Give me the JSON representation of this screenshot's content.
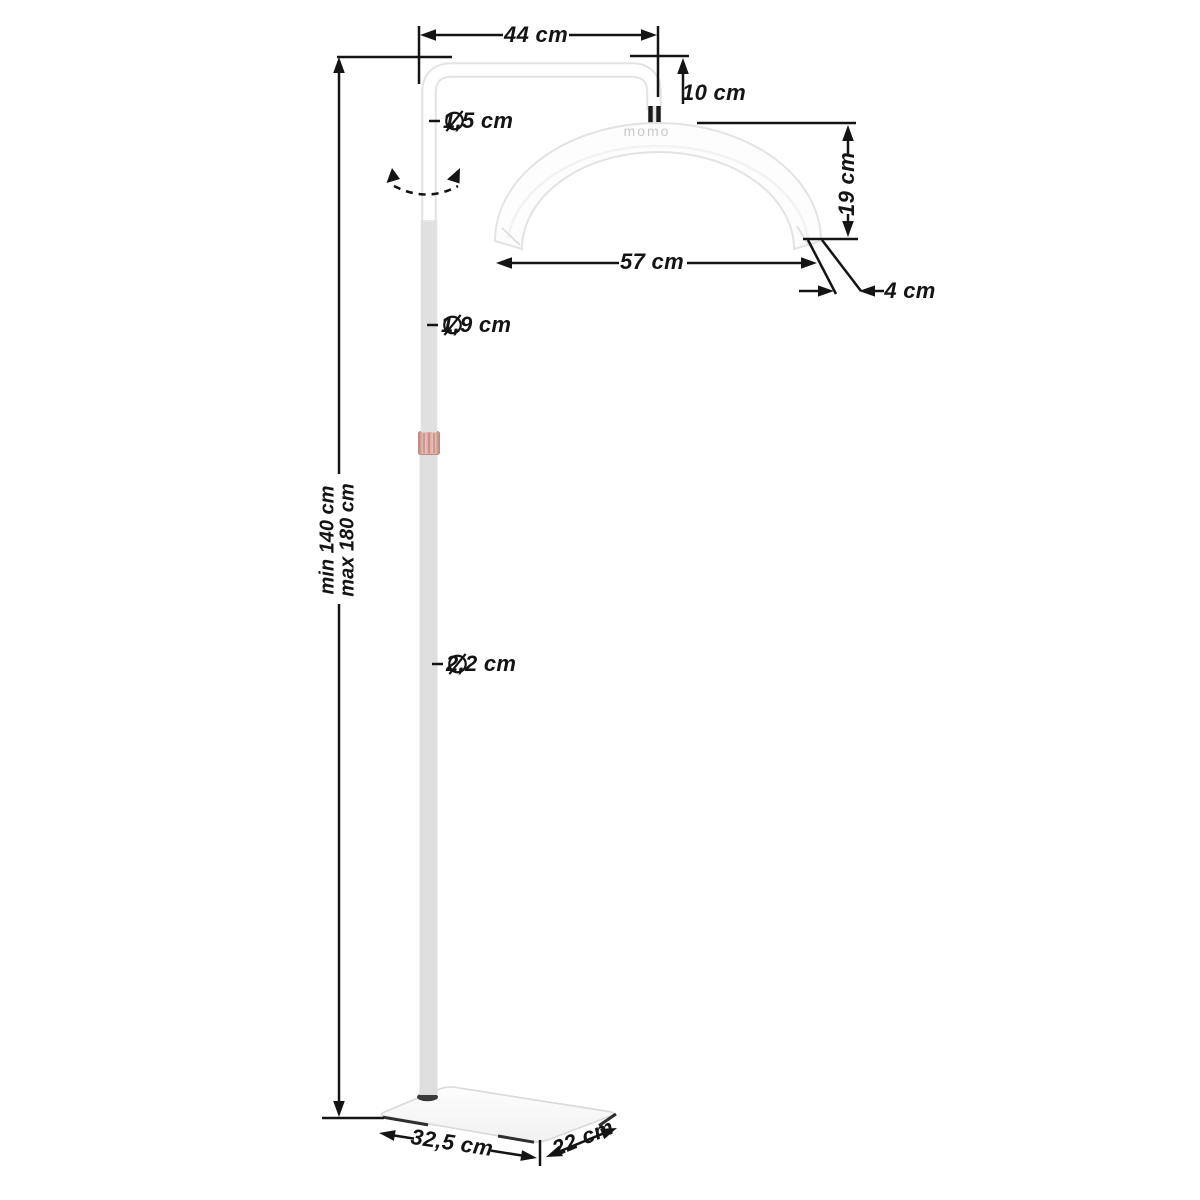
{
  "meta": {
    "title": "Half-moon LED floor lamp — dimension diagram"
  },
  "brand": {
    "logo_text": "momo"
  },
  "icons": {
    "diameter": "circle-with-slash",
    "rotation": "curved-double-arrow-dashed"
  },
  "colors": {
    "dimension_line": "#141414",
    "tube_outline": "#e3e3e3",
    "tube_fill": "#ffffff",
    "logo_gray": "#c9c9c9",
    "collar_rose": "#dda59d",
    "base_outline": "#d9d9d9",
    "connector_dark": "#191919"
  },
  "labels": {
    "arm_length": "44 cm",
    "arm_drop": "10 cm",
    "upper_tube_diameter": "1,5 cm",
    "head_height": "19 cm",
    "head_span": "57 cm",
    "head_tube_width": "4 cm",
    "mid_tube_diameter": "1,9 cm",
    "height_min": "min 140 cm",
    "height_max": "max 180 cm",
    "lower_tube_diameter": "2,2 cm",
    "base_length": "32,5 cm",
    "base_depth": "22 cm"
  }
}
